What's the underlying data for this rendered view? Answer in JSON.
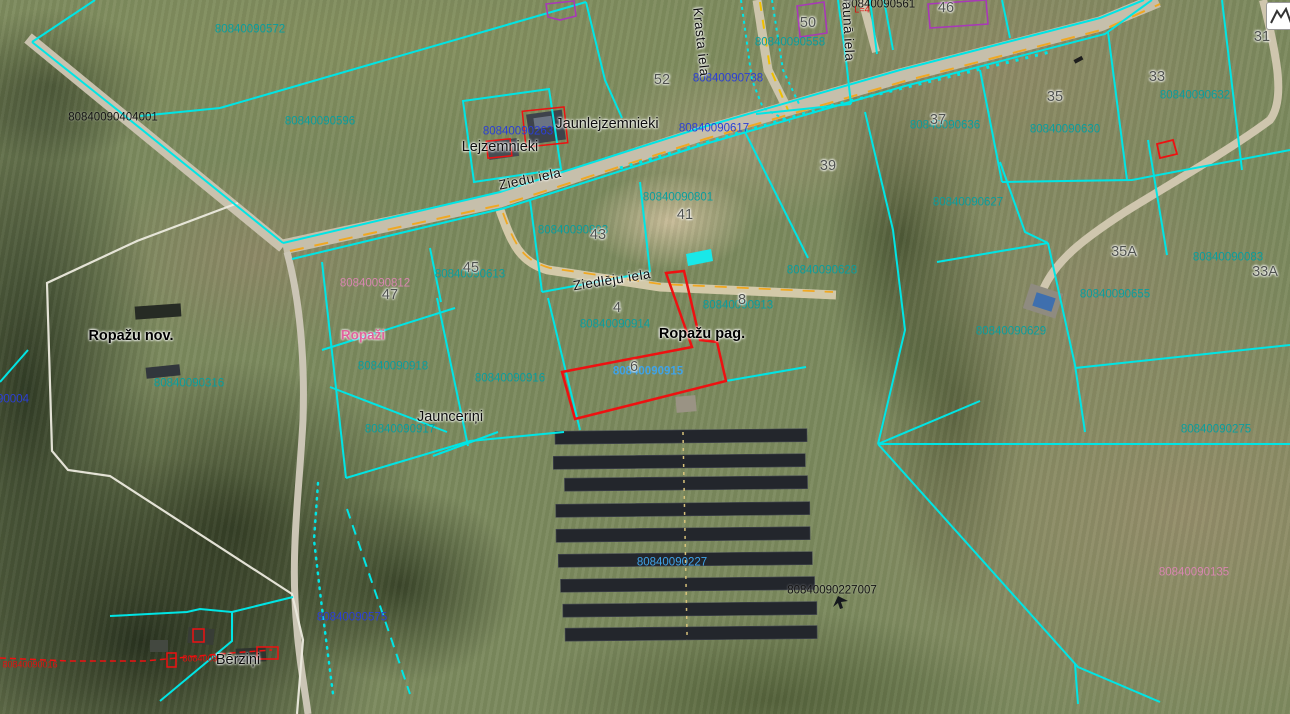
{
  "map": {
    "type": "cadastral-aerial-map",
    "colors": {
      "parcel_line": "#00e5e5",
      "selected_outline": "#ee1111",
      "road_centerline": "#f0a822",
      "parcel_number": "#0a9e9e",
      "building_number": "#2b3fd6",
      "address_number": "#4f524f",
      "zoning_pink": "#d886b0",
      "municipality_border": "#eceade"
    },
    "icons": {
      "map_tool": "mountain-zigzag-icon",
      "solar_marker": "small-arrow-icon"
    },
    "labels": [
      {
        "name": "parcel-number-80840090572",
        "text": "80840090572",
        "x": 250,
        "y": 30,
        "cls": "num-teal"
      },
      {
        "name": "parcel-number-80840090596",
        "text": "80840090596",
        "x": 320,
        "y": 122,
        "cls": "num-teal"
      },
      {
        "name": "parcel-number-80840090558",
        "text": "80840090558",
        "x": 790,
        "y": 43,
        "cls": "num-teal"
      },
      {
        "name": "parcel-number-80840090801",
        "text": "80840090801",
        "x": 678,
        "y": 198,
        "cls": "num-teal"
      },
      {
        "name": "parcel-number-80840090803",
        "text": "80840090803",
        "x": 573,
        "y": 231,
        "cls": "num-teal"
      },
      {
        "name": "parcel-number-80840090613",
        "text": "80840090613",
        "x": 470,
        "y": 275,
        "cls": "num-teal"
      },
      {
        "name": "parcel-number-80840090918",
        "text": "80840090918",
        "x": 393,
        "y": 367,
        "cls": "num-teal"
      },
      {
        "name": "parcel-number-80840090916",
        "text": "80840090916",
        "x": 510,
        "y": 379,
        "cls": "num-teal"
      },
      {
        "name": "parcel-number-80840090914",
        "text": "80840090914",
        "x": 615,
        "y": 325,
        "cls": "num-teal"
      },
      {
        "name": "parcel-number-80840090913",
        "text": "80840090913",
        "x": 738,
        "y": 306,
        "cls": "num-teal"
      },
      {
        "name": "parcel-number-80840090917",
        "text": "80840090917",
        "x": 400,
        "y": 430,
        "cls": "num-teal"
      },
      {
        "name": "parcel-number-80840090316",
        "text": "80840090316",
        "x": 189,
        "y": 384,
        "cls": "num-teal"
      },
      {
        "name": "parcel-number-80840090628",
        "text": "80840090628",
        "x": 822,
        "y": 271,
        "cls": "num-teal"
      },
      {
        "name": "parcel-number-80840090627",
        "text": "80840090627",
        "x": 968,
        "y": 203,
        "cls": "num-teal"
      },
      {
        "name": "parcel-number-80840090629",
        "text": "80840090629",
        "x": 1011,
        "y": 332,
        "cls": "num-teal"
      },
      {
        "name": "parcel-number-80840090655",
        "text": "80840090655",
        "x": 1115,
        "y": 295,
        "cls": "num-teal"
      },
      {
        "name": "parcel-number-80840090630",
        "text": "80840090630",
        "x": 1065,
        "y": 130,
        "cls": "num-teal"
      },
      {
        "name": "parcel-number-80840090632",
        "text": "80840090632",
        "x": 1195,
        "y": 96,
        "cls": "num-teal"
      },
      {
        "name": "parcel-number-80840090636",
        "text": "80840090636",
        "x": 945,
        "y": 126,
        "cls": "num-teal"
      },
      {
        "name": "parcel-number-80840090083",
        "text": "80840090083",
        "x": 1228,
        "y": 258,
        "cls": "num-teal"
      },
      {
        "name": "parcel-number-80840090275",
        "text": "80840090275",
        "x": 1216,
        "y": 430,
        "cls": "num-teal"
      },
      {
        "name": "building-number-80840090617",
        "text": "80840090617",
        "x": 714,
        "y": 129,
        "cls": "num-blue"
      },
      {
        "name": "building-number-80840090738",
        "text": "80840090738",
        "x": 728,
        "y": 79,
        "cls": "num-blue"
      },
      {
        "name": "building-number-80840090575",
        "text": "80840090575",
        "x": 352,
        "y": 618,
        "cls": "num-blue"
      },
      {
        "name": "building-number-90004",
        "text": "90004",
        "x": 13,
        "y": 400,
        "cls": "num-blue"
      },
      {
        "name": "building-number-80840090263",
        "text": "80840090263",
        "x": 518,
        "y": 132,
        "cls": "num-blue"
      },
      {
        "name": "parcel-number-80840090915",
        "text": "80840090915",
        "x": 648,
        "y": 372,
        "cls": "num-lblue bold"
      },
      {
        "name": "parcel-number-80840090227",
        "text": "80840090227",
        "x": 672,
        "y": 563,
        "cls": "num-lblue"
      },
      {
        "name": "zoning-number-80840090812",
        "text": "80840090812",
        "x": 375,
        "y": 284,
        "cls": "num-pink"
      },
      {
        "name": "zoning-number-80840090135",
        "text": "80840090135",
        "x": 1194,
        "y": 573,
        "cls": "num-pink"
      },
      {
        "name": "place-name-ropazi",
        "text": "Ropaži",
        "x": 363,
        "y": 335,
        "cls": "name-pink"
      },
      {
        "name": "address-number-52",
        "text": "52",
        "x": 662,
        "y": 80,
        "cls": "num-gray"
      },
      {
        "name": "address-number-50",
        "text": "50",
        "x": 808,
        "y": 23,
        "cls": "num-gray"
      },
      {
        "name": "address-number-46",
        "text": "46",
        "x": 946,
        "y": 8,
        "cls": "num-gray"
      },
      {
        "name": "address-number-31",
        "text": "31",
        "x": 1262,
        "y": 37,
        "cls": "num-gray"
      },
      {
        "name": "address-number-33",
        "text": "33",
        "x": 1157,
        "y": 77,
        "cls": "num-gray"
      },
      {
        "name": "address-number-35",
        "text": "35",
        "x": 1055,
        "y": 97,
        "cls": "num-gray"
      },
      {
        "name": "address-number-37",
        "text": "37",
        "x": 938,
        "y": 120,
        "cls": "num-gray"
      },
      {
        "name": "address-number-39",
        "text": "39",
        "x": 828,
        "y": 166,
        "cls": "num-gray"
      },
      {
        "name": "address-number-41",
        "text": "41",
        "x": 685,
        "y": 215,
        "cls": "num-gray"
      },
      {
        "name": "address-number-43",
        "text": "43",
        "x": 598,
        "y": 235,
        "cls": "num-gray"
      },
      {
        "name": "address-number-45",
        "text": "45",
        "x": 471,
        "y": 268,
        "cls": "num-gray"
      },
      {
        "name": "address-number-47",
        "text": "47",
        "x": 390,
        "y": 295,
        "cls": "num-gray"
      },
      {
        "name": "address-number-4",
        "text": "4",
        "x": 617,
        "y": 308,
        "cls": "num-gray"
      },
      {
        "name": "address-number-8",
        "text": "8",
        "x": 742,
        "y": 300,
        "cls": "num-gray"
      },
      {
        "name": "address-number-6",
        "text": "6",
        "x": 634,
        "y": 367,
        "cls": "num-gray"
      },
      {
        "name": "address-number-35a",
        "text": "35A",
        "x": 1124,
        "y": 252,
        "cls": "num-gray"
      },
      {
        "name": "address-number-33a",
        "text": "33A",
        "x": 1265,
        "y": 272,
        "cls": "num-gray"
      },
      {
        "name": "place-name-jaunlejzemnieki",
        "text": "Jaunlejzemnieki",
        "x": 607,
        "y": 124,
        "cls": "name-black"
      },
      {
        "name": "place-name-lejzemnieki",
        "text": "Lejzemnieki",
        "x": 500,
        "y": 147,
        "cls": "name-black"
      },
      {
        "name": "place-name-jauncerini",
        "text": "Jaunceriņi",
        "x": 450,
        "y": 417,
        "cls": "name-black"
      },
      {
        "name": "place-name-berzini",
        "text": "Bērziņi",
        "x": 238,
        "y": 660,
        "cls": "name-black"
      },
      {
        "name": "parcel-number-80840090404001",
        "text": "80840090404001",
        "x": 113,
        "y": 118,
        "cls": "num-black"
      },
      {
        "name": "parcel-number-80840090561",
        "text": "80840090561",
        "x": 880,
        "y": 5,
        "cls": "num-black"
      },
      {
        "name": "parcel-number-80840090227007",
        "text": "80840090227007",
        "x": 832,
        "y": 591,
        "cls": "num-black"
      },
      {
        "name": "municipality-name-ropazu-nov",
        "text": "Ropažu nov.",
        "x": 131,
        "y": 336,
        "cls": "name-bold"
      },
      {
        "name": "parish-name-ropazu-pag",
        "text": "Ropažu pag.",
        "x": 702,
        "y": 334,
        "cls": "name-bold"
      },
      {
        "name": "road-name-ziedu-iela",
        "text": "Ziedu iela",
        "x": 530,
        "y": 179,
        "cls": "road-name",
        "rot": -12
      },
      {
        "name": "road-name-ziedleju-iela",
        "text": "Ziedlēju iela",
        "x": 612,
        "y": 280,
        "cls": "road-name",
        "rot": -9
      },
      {
        "name": "road-name-krasta-iela",
        "text": "Krasta iela",
        "x": 701,
        "y": 42,
        "cls": "road-name",
        "rot": 84
      },
      {
        "name": "road-name-jauna-iela",
        "text": "Jaunā iela",
        "x": 848,
        "y": 28,
        "cls": "road-name",
        "rot": 87
      },
      {
        "name": "red-number-fragment",
        "text": "8084009",
        "x": 200,
        "y": 659,
        "cls": "num-red"
      },
      {
        "name": "red-number-left",
        "text": "80840090016",
        "x": 30,
        "y": 665,
        "cls": "num-red"
      },
      {
        "name": "red-measure-label",
        "text": "L=4",
        "x": 862,
        "y": 10,
        "cls": "num-red"
      }
    ]
  }
}
